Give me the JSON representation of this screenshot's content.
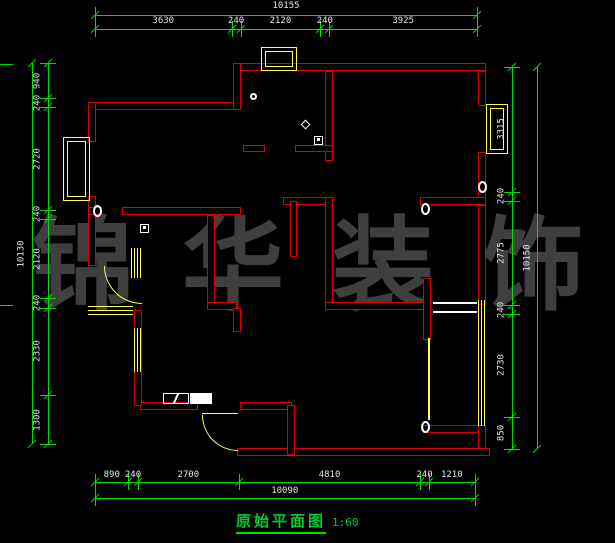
{
  "title": {
    "text": "原始平面图",
    "scale": "1:60"
  },
  "watermark": {
    "chars": [
      "锦",
      "华",
      "装",
      "饰"
    ]
  },
  "colors": {
    "background": "#000000",
    "wall": "#dd0000",
    "dimension_line": "#00dd00",
    "dimension_text": "#e6e6e6",
    "window": "#ffff55",
    "symbol": "#ffffff",
    "watermark": "#3f3f3f",
    "title": "#00cc33"
  },
  "dimensions": {
    "top": {
      "total": "10155",
      "segments": [
        "3630",
        "240",
        "2120",
        "240",
        "3925"
      ]
    },
    "left": {
      "total": "10130",
      "segments": [
        "940",
        "240",
        "2720",
        "240",
        "2120",
        "240",
        "2330",
        "1300"
      ]
    },
    "right": {
      "total": "10150",
      "segments": [
        "3315",
        "240",
        "2775",
        "240",
        "2730",
        "850"
      ]
    },
    "bottom": {
      "total": "10090",
      "segments": [
        "890",
        "240",
        "2700",
        "4810",
        "240",
        "1210"
      ]
    }
  }
}
